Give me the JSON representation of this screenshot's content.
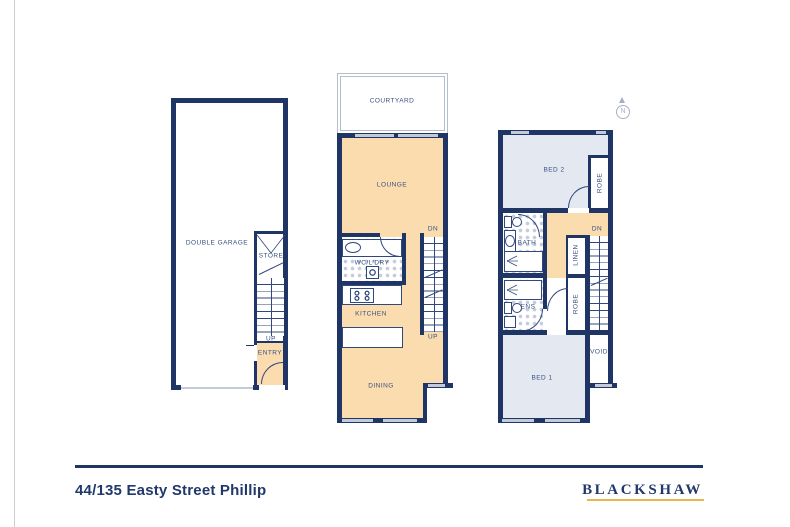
{
  "footer": {
    "address": "44/135 Easty Street Phillip",
    "brand": "BLACKSHAW"
  },
  "compass": {
    "letter": "N"
  },
  "garage": {
    "name": "DOUBLE GARAGE",
    "store": "STORE",
    "up": "UP",
    "entry": "ENTRY"
  },
  "mid": {
    "courtyard": "COURTYARD",
    "lounge": "LOUNGE",
    "wc_ldry": "WC/L'DRY",
    "kitchen": "KITCHEN",
    "dining": "DINING",
    "dn": "DN",
    "up": "UP"
  },
  "upper": {
    "bed2": "BED 2",
    "robe2": "ROBE",
    "bath": "BATH",
    "linen": "LINEN",
    "dn": "DN",
    "ens": "ENS",
    "robe1": "ROBE",
    "void": "VOID",
    "bed1": "BED 1"
  },
  "colors": {
    "wall_navy": "#1e3566",
    "floor_tan": "#fbdcae",
    "floor_blue": "#e3e8f1",
    "window_gray": "#c3cbd9",
    "brand_gold": "#eab54e",
    "label_navy": "#3a4f82"
  }
}
